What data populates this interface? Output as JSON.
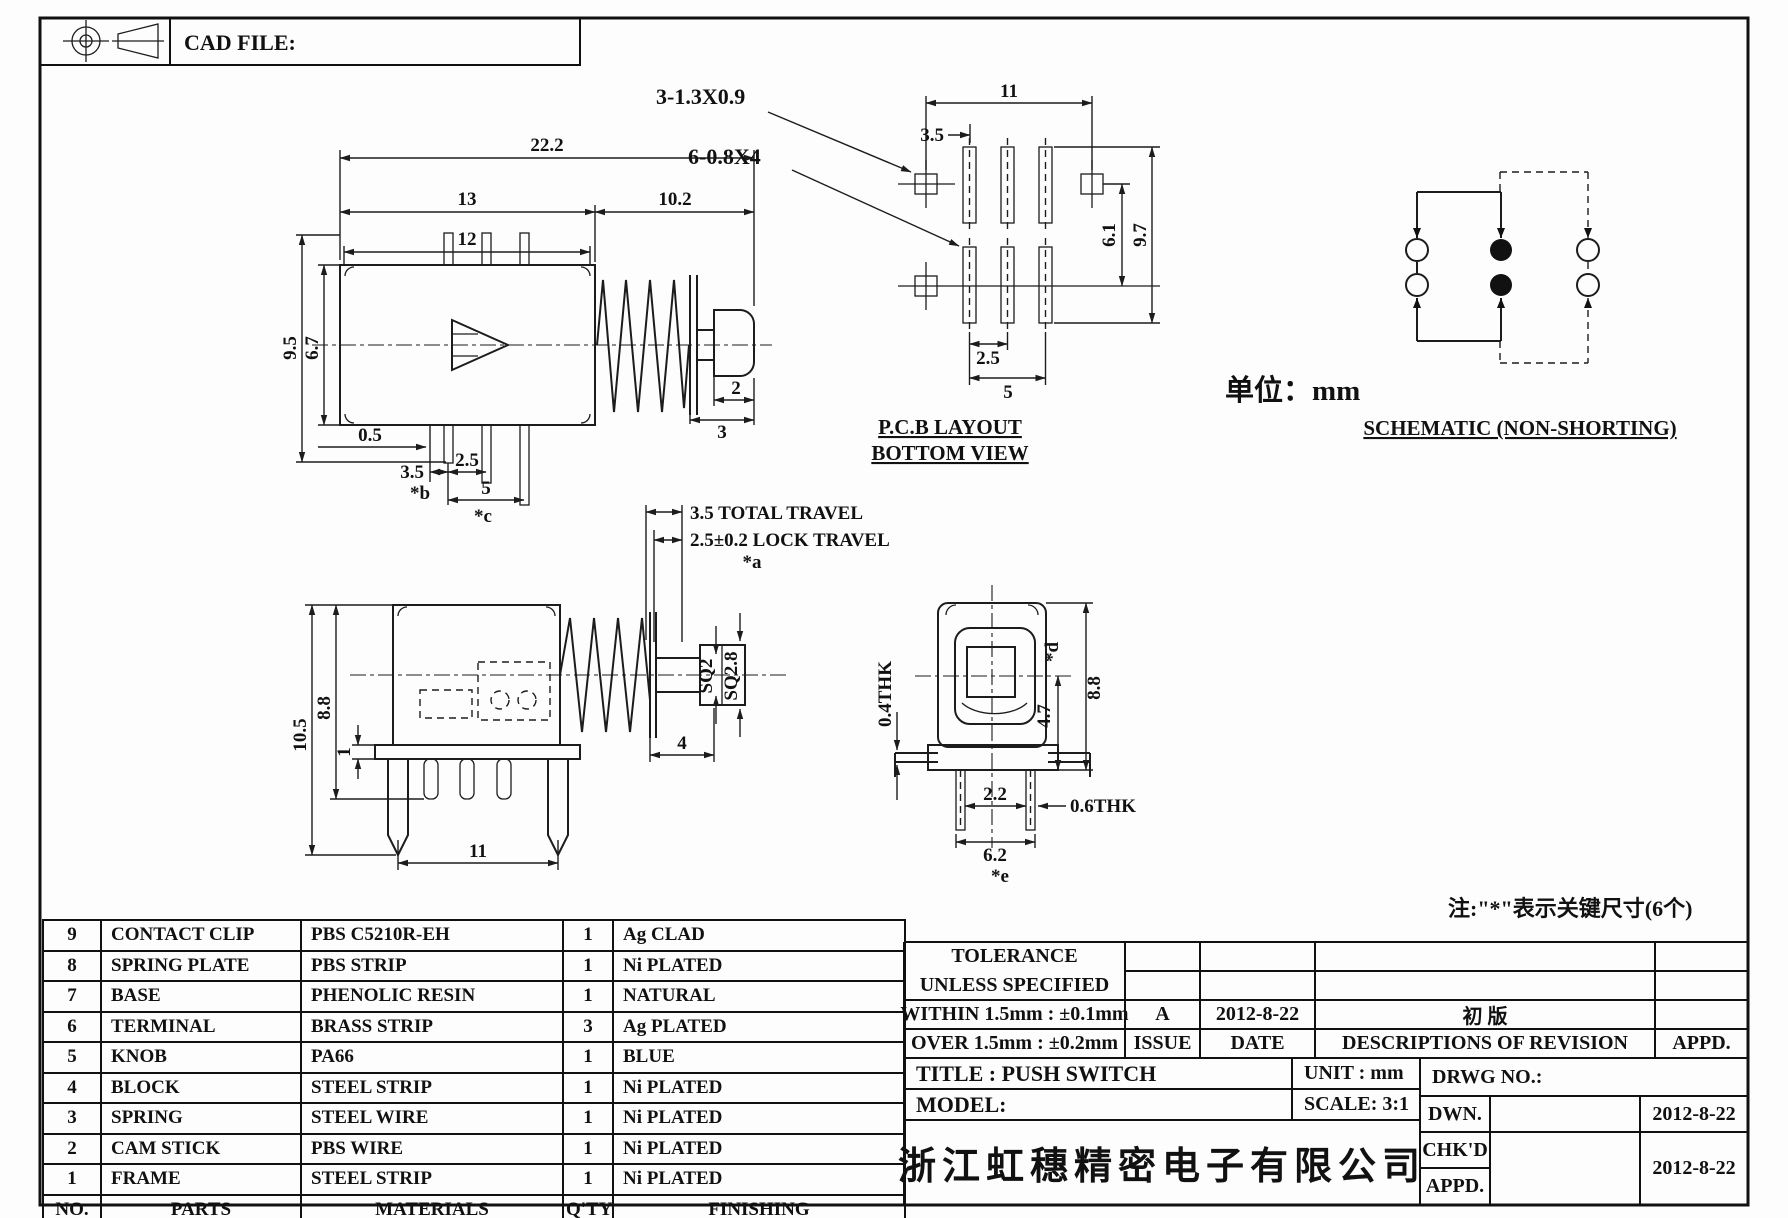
{
  "header": {
    "cad_file": "CAD FILE:"
  },
  "unit_label": "单位：mm",
  "note_key": "注:\"*\"表示关键尺寸(6个)",
  "side_view": {
    "d_total_w": "22.2",
    "d_body_w": "13",
    "d_right_w": "10.2",
    "d_pins_w": "12",
    "d_total_h": "9.5",
    "d_body_h": "6.7",
    "d_offset": "0.5",
    "d_pitch_a": "3.5",
    "key_b": "*b",
    "d_pitch_b": "2.5",
    "d_span": "5",
    "key_c": "*c",
    "d_knob": "2",
    "d_shaft": "3"
  },
  "pcb": {
    "caption1": "P.C.B LAYOUT",
    "caption2": "BOTTOM VIEW",
    "hole3": "3-1.3X0.9",
    "hole6": "6-0.8X4",
    "d11": "11",
    "d35": "3.5",
    "d61": "6.1",
    "d97": "9.7",
    "d25": "2.5",
    "d5": "5"
  },
  "schematic": {
    "caption": "SCHEMATIC (NON-SHORTING)"
  },
  "travel_view": {
    "total": "3.5 TOTAL TRAVEL",
    "lock": "2.5±0.2 LOCK TRAVEL",
    "key_a": "*a",
    "d105": "10.5",
    "d88": "8.8",
    "d1": "1",
    "d11": "11",
    "sq2": "SQ2",
    "sq28": "SQ2.8",
    "d4": "4"
  },
  "front_view": {
    "thk04": "0.4THK",
    "key_d": "*d",
    "d47": "4.7",
    "d88": "8.8",
    "d22": "2.2",
    "thk06": "0.6THK",
    "d62": "6.2",
    "key_e": "*e"
  },
  "parts_table": {
    "headers": [
      "NO.",
      "PARTS",
      "MATERIALS",
      "Q'TY",
      "FINISHING"
    ],
    "rows": [
      [
        "9",
        "CONTACT CLIP",
        "PBS C5210R-EH",
        "1",
        "Ag CLAD"
      ],
      [
        "8",
        "SPRING PLATE",
        "PBS STRIP",
        "1",
        "Ni PLATED"
      ],
      [
        "7",
        "BASE",
        "PHENOLIC RESIN",
        "1",
        "NATURAL"
      ],
      [
        "6",
        "TERMINAL",
        "BRASS STRIP",
        "3",
        "Ag PLATED"
      ],
      [
        "5",
        "KNOB",
        "PA66",
        "1",
        "BLUE"
      ],
      [
        "4",
        "BLOCK",
        "STEEL STRIP",
        "1",
        "Ni PLATED"
      ],
      [
        "3",
        "SPRING",
        "STEEL WIRE",
        "1",
        "Ni PLATED"
      ],
      [
        "2",
        "CAM STICK",
        "PBS WIRE",
        "1",
        "Ni PLATED"
      ],
      [
        "1",
        "FRAME",
        "STEEL STRIP",
        "1",
        "Ni PLATED"
      ]
    ]
  },
  "title_block": {
    "tolerance1": "TOLERANCE",
    "tolerance2": "UNLESS  SPECIFIED",
    "within": "WITHIN 1.5mm : ±0.1mm",
    "over": "OVER 1.5mm : ±0.2mm",
    "issue_value": "A",
    "issue_label": "ISSUE",
    "date_value": "2012-8-22",
    "date_label": "DATE",
    "revision_desc": "初 版",
    "revision_header": "DESCRIPTIONS OF REVISION",
    "appd_header": "APPD.",
    "title": "TITLE : PUSH SWITCH",
    "unit": "UNIT :  mm",
    "drwg_no": "DRWG NO.:",
    "model": "MODEL:",
    "scale": "SCALE:  3:1",
    "dwn_label": "DWN.",
    "dwn_date": "2012-8-22",
    "chkd_label": "CHK'D",
    "appd_label": "APPD.",
    "chkd_appd_date": "2012-8-22",
    "company": "浙江虹穗精密电子有限公司"
  }
}
